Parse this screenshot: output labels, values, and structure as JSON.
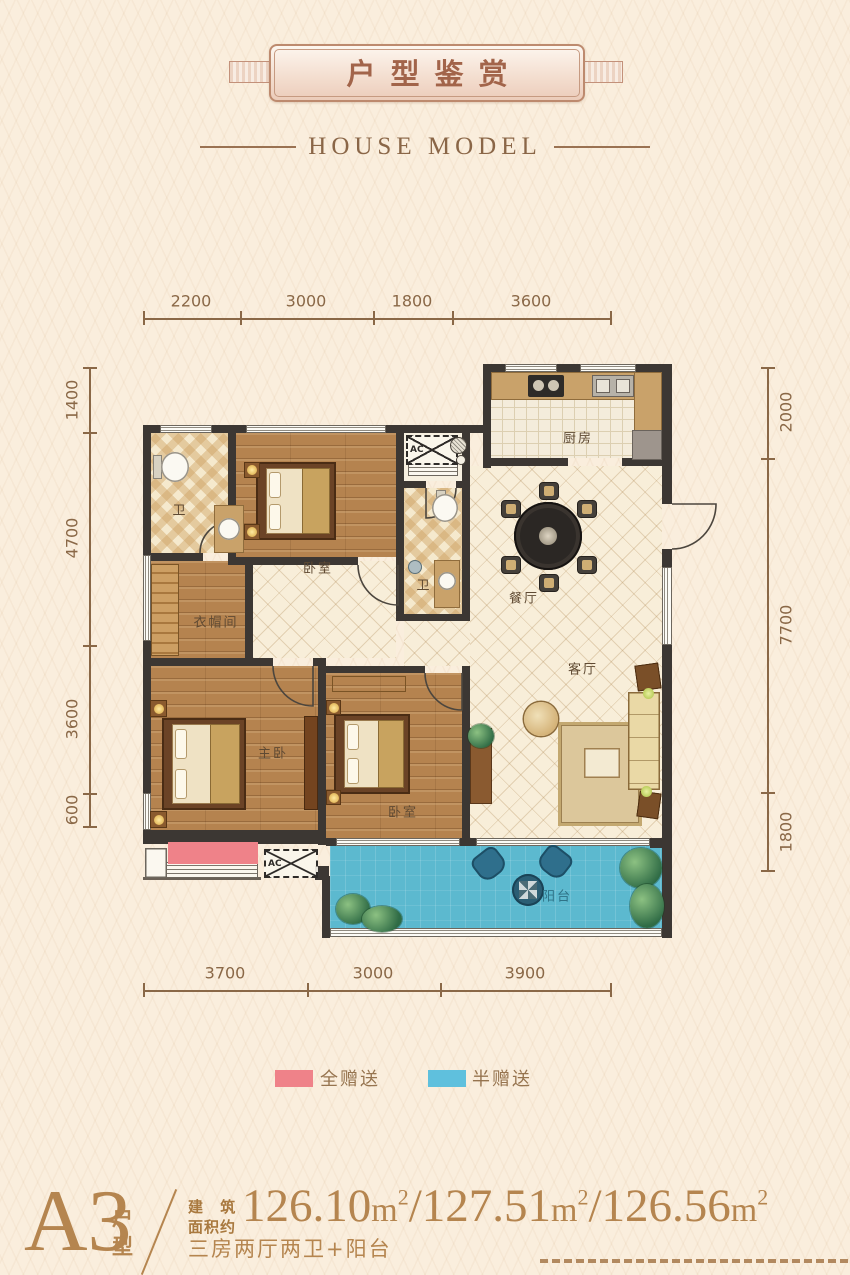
{
  "header": {
    "title": "户型鉴赏",
    "subtitle": "HOUSE MODEL"
  },
  "dims": {
    "top": [
      "2200",
      "3000",
      "1800",
      "3600"
    ],
    "bottom": [
      "3700",
      "3000",
      "3900"
    ],
    "left": [
      "1400",
      "4700",
      "3600",
      "600"
    ],
    "right": [
      "2000",
      "7700",
      "1800"
    ]
  },
  "rooms": {
    "kitchen": "厨房",
    "dining": "餐厅",
    "living": "客厅",
    "bath1": "卫",
    "bath2": "卫",
    "bedroom1": "卧室",
    "bedroom2": "卧室",
    "master": "主卧",
    "cloakroom": "衣帽间",
    "balcony": "阳台",
    "ac": "AC"
  },
  "legend": {
    "full": {
      "label": "全赠送",
      "color": "#ef8289"
    },
    "half": {
      "label": "半赠送",
      "color": "#5fc0dd"
    }
  },
  "footer": {
    "plan_code": "A3",
    "plan_type": "户型",
    "area_label_line1": "建 筑",
    "area_label_line2": "面积约",
    "areas": [
      "126.10",
      "127.51",
      "126.56"
    ],
    "unit_base": "m",
    "unit_sup": "2",
    "sep": "/",
    "layout_desc": "三房两厅两卫+阳台"
  },
  "colors": {
    "accent_copper": "#b5854f",
    "wall": "#3c3733",
    "balcony_blue": "#5cb9cf",
    "gift_full_pink": "#ef8289",
    "gift_half_blue": "#5fc0dd"
  }
}
